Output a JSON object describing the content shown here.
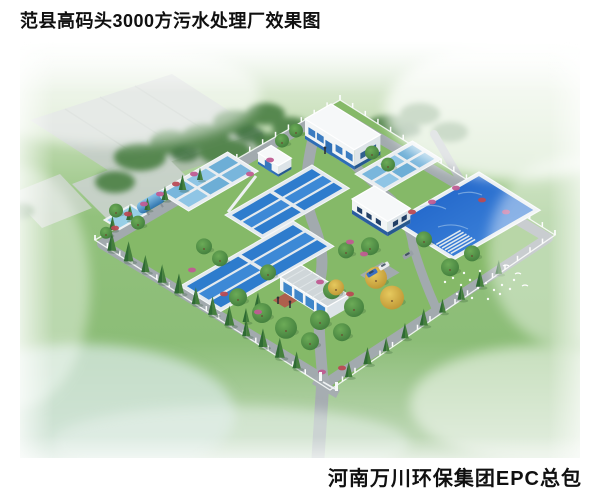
{
  "page": {
    "background": "#ffffff",
    "title": "范县高码头3000方污水处理厂效果图",
    "credit": "河南万川环保集团EPC总包"
  },
  "scene": {
    "kind": "aerial architectural rendering",
    "facility": "3000方污水处理厂",
    "elements": {
      "pools": [
        "aeration basin upper",
        "aeration basin lower",
        "cell clarifier basin west",
        "cell clarifier basin east",
        "clear water pond",
        "small pond",
        "blue storage tank"
      ],
      "buildings": [
        "main workshop building",
        "dosing hut",
        "equipment building",
        "office building"
      ],
      "site": [
        "perimeter fence",
        "entrance gate",
        "plant roads",
        "cypress and round trees",
        "autumn trees",
        "flower bushes",
        "parked cars",
        "white birds",
        "greenhouse sheds background"
      ]
    },
    "palette": {
      "grass": "#8cbd77",
      "water_deep": "#1f6bc8",
      "water_light": "#7fb9de",
      "road": "#a2aaae",
      "building_wall": "#f3f6f7",
      "building_accent": "#2e6db5",
      "fence": "#f7f9f9"
    }
  }
}
